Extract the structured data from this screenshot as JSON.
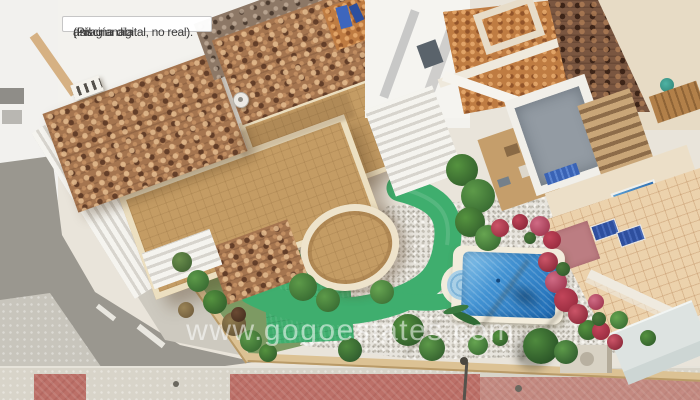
{
  "overlay": {
    "note_lines": [
      "¡Imagíanala",
      "así!",
      "(Piscina digital, no real)."
    ],
    "watermark": "www.gogoestates.com"
  },
  "scene": {
    "description": "Aerial drone photo of a villa plot: terracotta tiled roofs, large sand-coloured roof terrace with balustrade and curved balcony, gravel garden crossed by a bright artificial-turf path, digitally added blue pool with roman steps, bougainvillea along the fence, neighbouring terraces with sun loungers, grey street and red-paved sidewalk",
    "palette": {
      "roof_tile": "#a5754f",
      "roof_tile_dark": "#7a5640",
      "terrace_sand": "#c49c64",
      "balustrade": "#ecdfc0",
      "turf_green": "#3fae6e",
      "gravel": "#e7e4dd",
      "pool_water_deep": "#1e6cb6",
      "pool_water_light": "#8ec8ec",
      "pool_coping": "#f2ecdc",
      "bougainvillea": "#b13a4a",
      "asphalt": "#9a978f",
      "sidewalk": "#d8d4c9",
      "red_paving": "#bc7068",
      "neighbor_tile_peach": "#ecd2ac",
      "lounger_blue": "#2e4f9e",
      "white_wall": "#f3f2ee"
    }
  }
}
